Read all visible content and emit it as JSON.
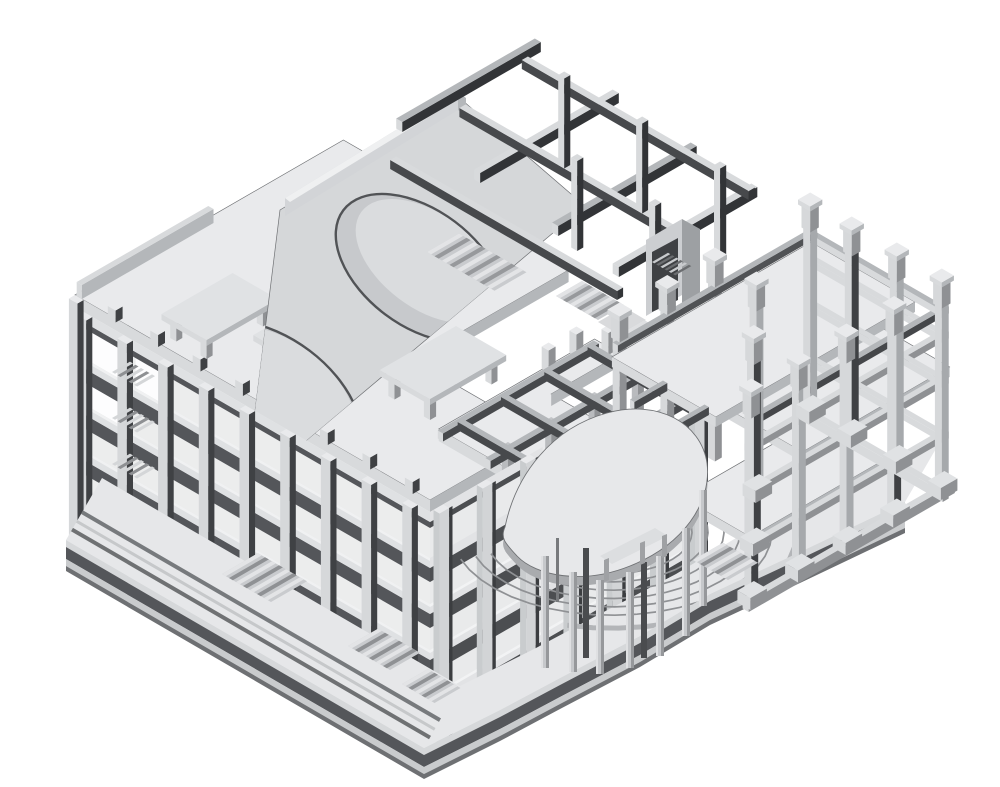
{
  "scene": {
    "type": "axonometric-structural-model",
    "description": "Monochrome 3D axonometric view of a reinforced-concrete building structural frame: multi-storey slab-and-column block with cut-away floors, a sloped roof shell with two elliptical openings over a dark beam grid, rooftop canopy tables, a fan-shaped mezzanine slab on cylindrical columns above curved amphitheater steps, and an open column-and-beam wing on the right, all standing on a stepped base plinth.",
    "background": "#ffffff"
  },
  "palette": {
    "background": "#ffffff",
    "slab_top": "#e9eaec",
    "slab_top_dim": "#e0e2e4",
    "face_light": "#d8dadc",
    "face_mid": "#b4b7ba",
    "face_dark": "#8f9194",
    "beam_dark": "#47494c",
    "beam_darker": "#323437",
    "recess_shadow": "#54565a",
    "edge_line": "#6f7174",
    "interior_fill": "#eceded",
    "column_shade": "#3f4144",
    "column_light": "#d6d8da",
    "cylinder": "#c6c8cb",
    "shell_panel": "#d5d7d9",
    "shell_opening": "#c7c9cc",
    "step_line": "#8f9194",
    "open_bay": "#fdfdfe"
  },
  "components": [
    "ground-plinth",
    "plaza-terrace",
    "amphitheater-steps",
    "fan-slab",
    "fan-columns",
    "spiral-stair",
    "main-roof-slab",
    "roof-shell-openings",
    "roof-beam-grid",
    "upper-deck",
    "deck-stair",
    "stair-tower",
    "left-facade",
    "front-facade",
    "interior-frame",
    "right-wing-frame",
    "column-stubs",
    "footings",
    "entrance-stairs",
    "rooftop-canopies"
  ]
}
